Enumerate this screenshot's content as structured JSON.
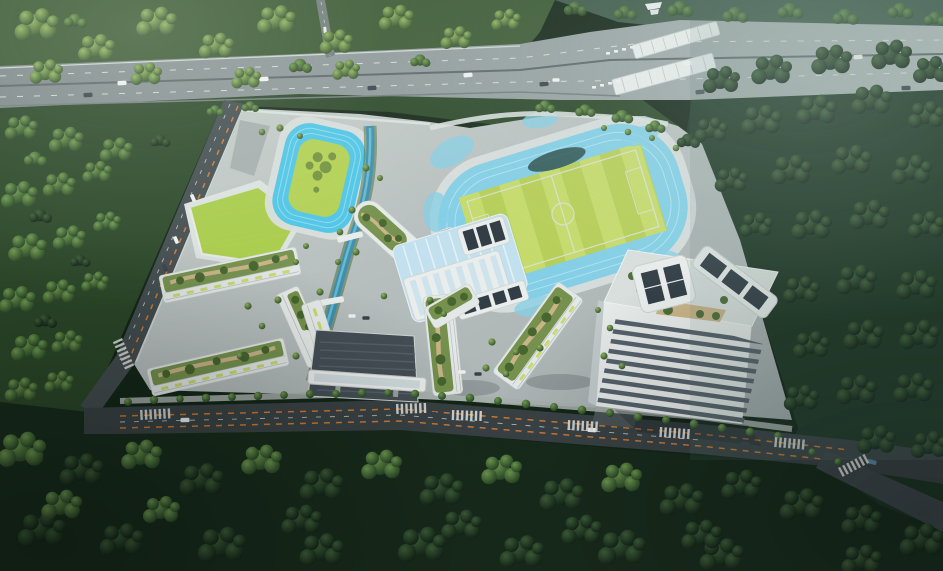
{
  "scene": {
    "title": "Aerial rendering of a forested school campus beside an expressway toll plaza",
    "labels": {
      "expressway": "elevated expressway with traffic",
      "toll_plaza": "toll canopies and booth lanes",
      "forest": "dense woodland surrounding the site",
      "campus": "low-rise campus with green roofs",
      "main_track": "oval track around striped sports pitch",
      "small_track": "practice oval with lawn infield",
      "lawn_wedge": "sloped lawn on podium roof",
      "canal": "landscaped water channel through campus",
      "atrium_hall": "central hall with ribbed skylight roof",
      "tower": "high-rise block with rooftop solar canopies and roof garden",
      "footbridge": "covered pedestrian footbridge",
      "perimeter_roads": "perimeter roads with orange bus-lane markings and zebra crossings"
    }
  },
  "colors": {
    "forest_dark": "#142618",
    "forest_mid": "#2b4729",
    "forest_light": "#3a5833",
    "highway_gray": "#8b9598",
    "road_asphalt": "#3a4245",
    "road_accent_orange": "#cf7a33",
    "marking_white": "#dfe3df",
    "campus_ground": "#b6bdbd",
    "building_white": "#e9edec",
    "glass_blue": "#c2e0ee",
    "solar_dark": "#323d46",
    "pitch_green": "#b7cf58",
    "pitch_stripe": "#c6db6c",
    "infield_green": "#b2d153",
    "lawn_green": "#a9cc4a",
    "track_blue_small": "#4ec5e7",
    "track_blue_main": "#85cfe6",
    "canal_water": "#3d8fae",
    "pond_dark": "#23443f",
    "roof_garden_green": "#75914d",
    "roof_path_tan": "#c9b488",
    "facade_accent_yellow_green": "#c9da6d",
    "window_band_dark": "#56616b"
  }
}
